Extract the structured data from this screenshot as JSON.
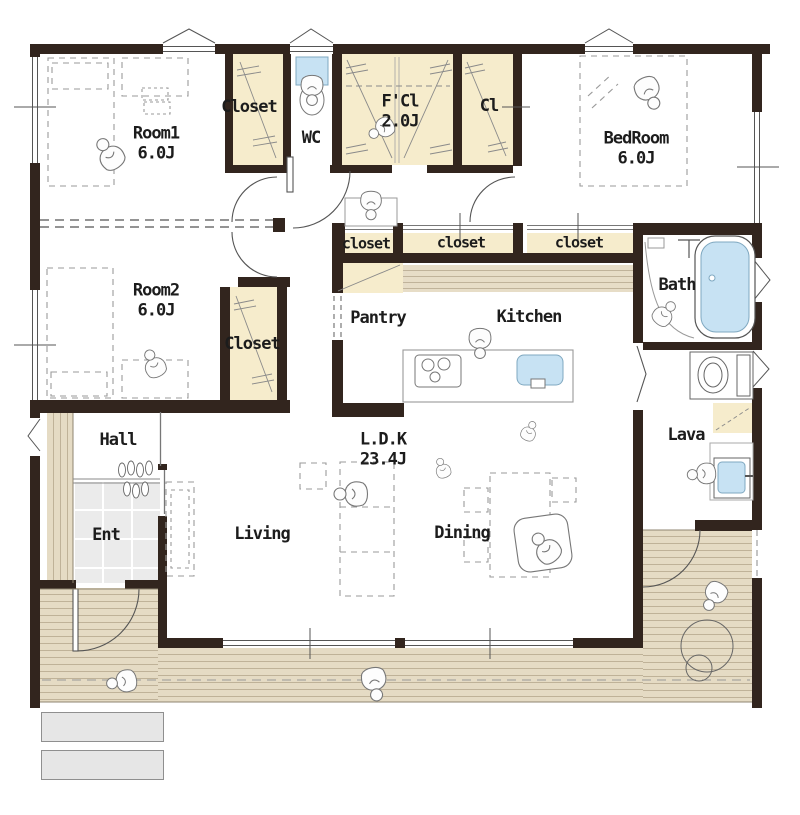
{
  "type": "floor-plan",
  "rooms": {
    "room1": {
      "name": "Room1",
      "size": "6.0J"
    },
    "closet_top": "Closet",
    "wc": "WC",
    "fcl": {
      "name": "F'Cl",
      "size": "2.0J"
    },
    "cl": "Cl",
    "bedroom": {
      "name": "BedRoom",
      "size": "6.0J"
    },
    "room2": {
      "name": "Room2",
      "size": "6.0J"
    },
    "closet_room2": "Closet",
    "closet_strip": [
      "closet",
      "closet",
      "closet"
    ],
    "bath": "Bath",
    "pantry": "Pantry",
    "kitchen": "Kitchen",
    "lava": "Lava",
    "hall": "Hall",
    "ent": "Ent",
    "living": "Living",
    "dining": "Dining",
    "ldk": {
      "name": "L.D.K",
      "size": "23.4J"
    }
  },
  "colors": {
    "wall": "#32251E",
    "closet_fill": "#F6ECCC",
    "deck_fill": "#E5DBC4",
    "water_fill": "#C7E2F3",
    "tile_fill": "#EBEBEB",
    "step_fill": "#E6E6E6"
  }
}
